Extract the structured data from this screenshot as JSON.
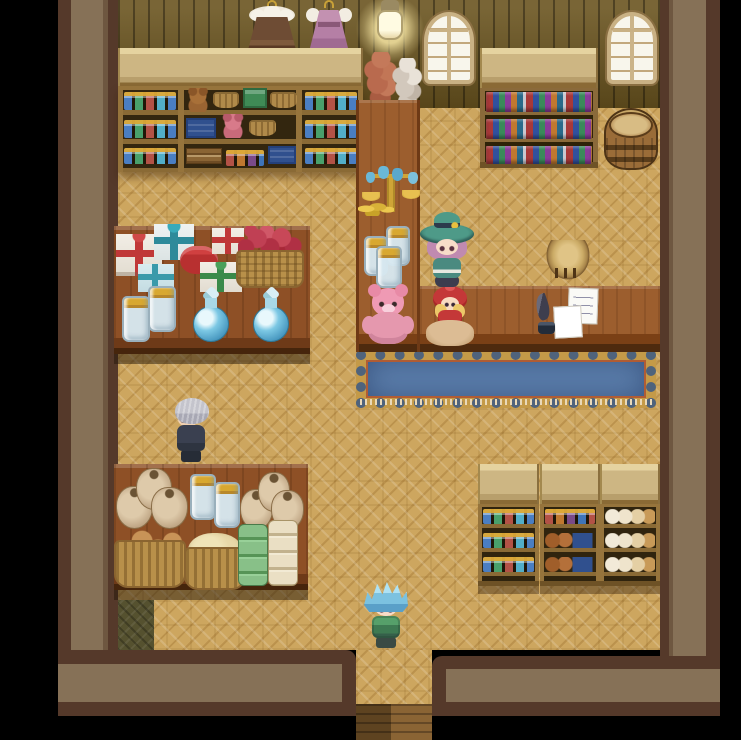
{
  "app": {
    "name": "rpg-shop-interior",
    "description": "Top-down RPG general store interior with wooden parquet floor, stocked shelves, counters and characters"
  },
  "palette": {
    "floor": "#cda65f",
    "plank": "#6a541f",
    "wall_fill": "#867157",
    "wall_edge": "#55392a",
    "counter": "#9c5e2e",
    "table_wood": "#8e5026",
    "carpet_blue": "#5d80ae",
    "carpet_gold": "#c49a48",
    "shelf_frame": "#96743c",
    "shelf_interior": "#33260f",
    "awning": "#cdb683",
    "background": "#000000"
  },
  "scene": {
    "width": 741,
    "height": 740,
    "entities": [
      {
        "name": "dark-floor-mat",
        "type": "mat-dark",
        "x": 118,
        "y": 600,
        "w": 36,
        "h": 50
      },
      {
        "name": "exit-steps",
        "type": "corridor-steps",
        "x": 356,
        "y": 704,
        "w": 76,
        "h": 36,
        "interactable": true
      },
      {
        "name": "hanging-dress-brown",
        "type": "dress-brown",
        "x": 246,
        "y": 0,
        "w": 52,
        "h": 50
      },
      {
        "name": "hanging-dress-pink",
        "type": "dress-pink",
        "x": 306,
        "y": 0,
        "w": 46,
        "h": 48
      },
      {
        "name": "hanging-lantern",
        "type": "lantern",
        "x": 370,
        "y": 0,
        "w": 40,
        "h": 48
      },
      {
        "name": "arched-window-left",
        "type": "window",
        "x": 424,
        "y": 12,
        "w": 50,
        "h": 72
      },
      {
        "name": "arched-window-right",
        "type": "window",
        "x": 607,
        "y": 12,
        "w": 50,
        "h": 72
      },
      {
        "name": "onion-braid",
        "type": "onion-braid",
        "x": 363,
        "y": 52,
        "w": 36,
        "h": 56
      },
      {
        "name": "garlic-braid",
        "type": "garlic-braid",
        "x": 391,
        "y": 58,
        "w": 33,
        "h": 52
      },
      {
        "name": "left-shelf-awning",
        "type": "awning",
        "x": 118,
        "y": 48,
        "w": 245,
        "h": 40
      },
      {
        "name": "left-goods-shelf",
        "type": "shelf-left",
        "x": 118,
        "y": 86,
        "w": 245,
        "h": 86
      },
      {
        "name": "bookshelf-awning",
        "type": "awning",
        "x": 480,
        "y": 48,
        "w": 118,
        "h": 40
      },
      {
        "name": "bookshelf",
        "type": "bookshelf",
        "x": 480,
        "y": 88,
        "w": 118,
        "h": 80
      },
      {
        "name": "book-row-top",
        "type": "book-row",
        "x": 486,
        "y": 92,
        "w": 106,
        "h": 20
      },
      {
        "name": "book-row-middle",
        "type": "book-row",
        "x": 486,
        "y": 119,
        "w": 106,
        "h": 20
      },
      {
        "name": "book-row-bottom",
        "type": "book-row",
        "x": 486,
        "y": 146,
        "w": 106,
        "h": 18
      },
      {
        "name": "wooden-barrel",
        "type": "barrel",
        "x": 604,
        "y": 108,
        "w": 54,
        "h": 62
      },
      {
        "name": "flower-pot",
        "type": "flowerpot",
        "x": 366,
        "y": 104,
        "w": 50,
        "h": 64
      },
      {
        "name": "potion-row-a1",
        "type": "jar-row",
        "x": 124,
        "y": 92,
        "w": 52,
        "h": 18
      },
      {
        "name": "potion-row-a2",
        "type": "jar-row",
        "x": 124,
        "y": 120,
        "w": 52,
        "h": 18
      },
      {
        "name": "potion-row-a3",
        "type": "jar-row",
        "x": 124,
        "y": 148,
        "w": 52,
        "h": 16
      },
      {
        "name": "potion-row-c1",
        "type": "jar-row",
        "x": 305,
        "y": 92,
        "w": 52,
        "h": 18
      },
      {
        "name": "potion-row-c2",
        "type": "jar-row",
        "x": 305,
        "y": 120,
        "w": 52,
        "h": 18
      },
      {
        "name": "potion-row-c3",
        "type": "jar-row",
        "x": 305,
        "y": 148,
        "w": 52,
        "h": 16
      },
      {
        "name": "shelf-teddy-brown",
        "type": "teddy-shelf",
        "x": 186,
        "y": 88,
        "w": 24,
        "h": 24
      },
      {
        "name": "shelf-basket-1",
        "type": "basket-goods",
        "x": 213,
        "y": 92,
        "w": 26,
        "h": 16
      },
      {
        "name": "shelf-green-crate",
        "type": "crate-green",
        "x": 243,
        "y": 88,
        "w": 24,
        "h": 20
      },
      {
        "name": "shelf-basket-2",
        "type": "basket-goods",
        "x": 270,
        "y": 92,
        "w": 27,
        "h": 16
      },
      {
        "name": "shelf-blue-crate-1",
        "type": "crate-blue",
        "x": 186,
        "y": 118,
        "w": 30,
        "h": 20
      },
      {
        "name": "shelf-teddy-pink",
        "type": "teddy-shelf pink",
        "x": 220,
        "y": 114,
        "w": 26,
        "h": 24
      },
      {
        "name": "shelf-basket-3",
        "type": "basket-goods",
        "x": 249,
        "y": 120,
        "w": 27,
        "h": 16
      },
      {
        "name": "shelf-books-stack",
        "type": "books-stack",
        "x": 186,
        "y": 148,
        "w": 36,
        "h": 16
      },
      {
        "name": "shelf-jar-row-warm",
        "type": "jar-row warm",
        "x": 226,
        "y": 150,
        "w": 38,
        "h": 16
      },
      {
        "name": "shelf-blue-crate-2",
        "type": "crate-blue",
        "x": 268,
        "y": 146,
        "w": 28,
        "h": 18
      },
      {
        "name": "blue-counter-carpet",
        "type": "carpet",
        "x": 356,
        "y": 350,
        "w": 300,
        "h": 58
      },
      {
        "name": "counter-vertical",
        "type": "counter v",
        "x": 356,
        "y": 100,
        "w": 64,
        "h": 252
      },
      {
        "name": "counter-horizontal",
        "type": "counter",
        "x": 420,
        "y": 286,
        "w": 240,
        "h": 66
      },
      {
        "name": "gift-display-table",
        "type": "table",
        "x": 114,
        "y": 226,
        "w": 196,
        "h": 128
      },
      {
        "name": "food-display-table",
        "type": "table",
        "x": 114,
        "y": 464,
        "w": 194,
        "h": 126
      },
      {
        "name": "br-awning-1",
        "type": "awning",
        "x": 478,
        "y": 464,
        "w": 61,
        "h": 42
      },
      {
        "name": "br-awning-2",
        "type": "awning",
        "x": 540,
        "y": 464,
        "w": 60,
        "h": 42
      },
      {
        "name": "br-awning-3",
        "type": "awning",
        "x": 600,
        "y": 464,
        "w": 60,
        "h": 42
      },
      {
        "name": "br-shelf-1",
        "type": "shelf-small",
        "x": 478,
        "y": 504,
        "w": 61,
        "h": 82
      },
      {
        "name": "br-shelf-2",
        "type": "shelf-small",
        "x": 540,
        "y": 504,
        "w": 60,
        "h": 82
      },
      {
        "name": "br-shelf-3",
        "type": "shelf-small",
        "x": 600,
        "y": 504,
        "w": 60,
        "h": 82
      },
      {
        "name": "br1-jar-row-1",
        "type": "jar-row",
        "x": 483,
        "y": 509,
        "w": 51,
        "h": 15
      },
      {
        "name": "br1-jar-row-2",
        "type": "jar-row",
        "x": 483,
        "y": 533,
        "w": 51,
        "h": 15
      },
      {
        "name": "br1-jar-row-3",
        "type": "jar-row",
        "x": 483,
        "y": 557,
        "w": 51,
        "h": 15
      },
      {
        "name": "br2-jar-row",
        "type": "jar-row warm",
        "x": 545,
        "y": 509,
        "w": 50,
        "h": 15
      },
      {
        "name": "br2-pot-row-1",
        "type": "pot-row",
        "x": 545,
        "y": 533,
        "w": 50,
        "h": 15
      },
      {
        "name": "br2-pot-row-2",
        "type": "pot-row",
        "x": 545,
        "y": 557,
        "w": 50,
        "h": 15
      },
      {
        "name": "br3-bread-row-1",
        "type": "bread-row",
        "x": 605,
        "y": 509,
        "w": 50,
        "h": 15
      },
      {
        "name": "br3-bread-row-2",
        "type": "bread-row",
        "x": 605,
        "y": 533,
        "w": 50,
        "h": 15
      },
      {
        "name": "br3-bread-row-3",
        "type": "bread-row",
        "x": 605,
        "y": 557,
        "w": 50,
        "h": 15
      },
      {
        "name": "gold-balance-scale",
        "type": "scale-gold",
        "x": 362,
        "y": 166,
        "w": 58,
        "h": 50
      },
      {
        "name": "coin-stacks",
        "type": "coins",
        "x": 358,
        "y": 198,
        "w": 36,
        "h": 18
      },
      {
        "name": "counter-jar-1",
        "type": "jar-glass",
        "x": 386,
        "y": 226,
        "w": 24,
        "h": 40
      },
      {
        "name": "counter-jar-2",
        "type": "jar-glass",
        "x": 364,
        "y": 236,
        "w": 24,
        "h": 40
      },
      {
        "name": "counter-jar-3",
        "type": "jar-glass",
        "x": 376,
        "y": 246,
        "w": 26,
        "h": 42
      },
      {
        "name": "pink-teddy-bear",
        "type": "teddy-big",
        "x": 362,
        "y": 286,
        "w": 52,
        "h": 60
      },
      {
        "name": "red-hood-doll",
        "type": "doll-redhood",
        "x": 426,
        "y": 286,
        "w": 48,
        "h": 60
      },
      {
        "name": "round-stool",
        "type": "stool",
        "x": 546,
        "y": 240,
        "w": 44,
        "h": 40
      },
      {
        "name": "note-papers",
        "type": "papers",
        "x": 554,
        "y": 288,
        "w": 44,
        "h": 50
      },
      {
        "name": "quill-and-ink",
        "type": "quill",
        "x": 534,
        "y": 294,
        "w": 26,
        "h": 40
      },
      {
        "name": "gift-boxes-pile",
        "type": "gifts",
        "x": 116,
        "y": 224,
        "w": 130,
        "h": 68
      },
      {
        "name": "apple-basket",
        "type": "apple-basket",
        "x": 236,
        "y": 226,
        "w": 68,
        "h": 62
      },
      {
        "name": "table-jar-1",
        "type": "jar-glass",
        "x": 148,
        "y": 286,
        "w": 28,
        "h": 46
      },
      {
        "name": "table-jar-2",
        "type": "jar-glass",
        "x": 122,
        "y": 296,
        "w": 28,
        "h": 46
      },
      {
        "name": "blue-potion-flask-1",
        "type": "flask-blue",
        "x": 190,
        "y": 288,
        "w": 42,
        "h": 54
      },
      {
        "name": "blue-potion-flask-2",
        "type": "flask-blue",
        "x": 250,
        "y": 288,
        "w": 42,
        "h": 54
      },
      {
        "name": "flour-sacks-left",
        "type": "sacks",
        "x": 116,
        "y": 468,
        "w": 72,
        "h": 64
      },
      {
        "name": "food-jar-1",
        "type": "jar-glass",
        "x": 190,
        "y": 474,
        "w": 26,
        "h": 46
      },
      {
        "name": "food-jar-2",
        "type": "jar-glass",
        "x": 214,
        "y": 482,
        "w": 26,
        "h": 46
      },
      {
        "name": "flour-sacks-right",
        "type": "sacks",
        "x": 240,
        "y": 472,
        "w": 64,
        "h": 60
      },
      {
        "name": "bread-roll-basket",
        "type": "bread-basket",
        "x": 114,
        "y": 522,
        "w": 72,
        "h": 66
      },
      {
        "name": "grain-basket",
        "type": "grain-basket",
        "x": 184,
        "y": 528,
        "w": 62,
        "h": 62
      },
      {
        "name": "fabric-bolt-stack",
        "type": "fabric-stack",
        "x": 238,
        "y": 520,
        "w": 60,
        "h": 66
      },
      {
        "name": "npc-elderly-man",
        "type": "char-oldman",
        "x": 168,
        "y": 398,
        "w": 48,
        "h": 66,
        "interactable": true,
        "desc": "gray-haired elderly man in dark clothes facing left"
      },
      {
        "name": "npc-shopkeeper-witch",
        "type": "char-witch",
        "x": 420,
        "y": 212,
        "w": 54,
        "h": 76,
        "interactable": true,
        "desc": "pink-haired shopkeeper wearing wide teal witch hat behind counter"
      },
      {
        "name": "player-hero",
        "type": "char-hero",
        "x": 360,
        "y": 580,
        "w": 52,
        "h": 68,
        "interactable": true,
        "desc": "blue-haired adventurer in green tunic near the exit"
      }
    ]
  }
}
